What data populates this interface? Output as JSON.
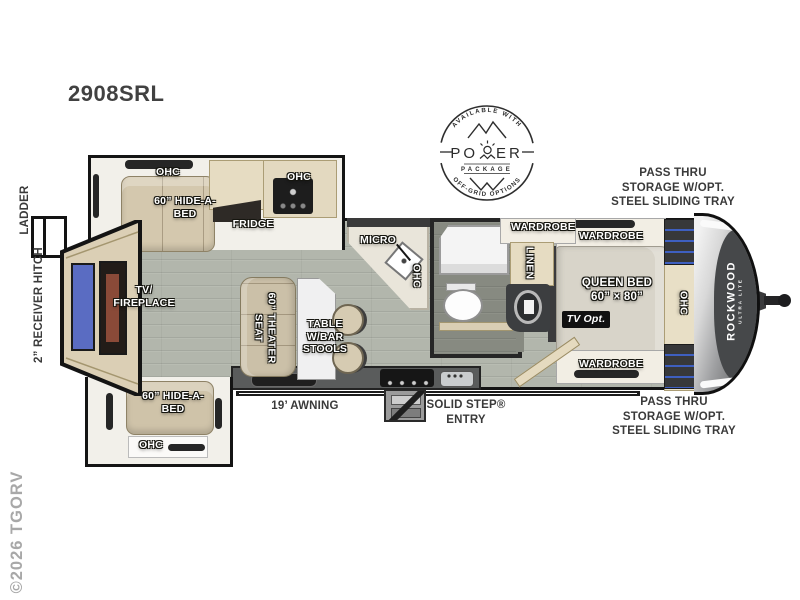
{
  "title": "2908SRL",
  "watermark": "©2026 TGORV",
  "badge": {
    "arc_top": "AVAILABLE WITH",
    "po": "PO",
    "er": "ER",
    "package": "PACKAGE",
    "arc_bottom": "OFF-GRID OPTIONS"
  },
  "branding": {
    "name": "ROCKWOOD",
    "sub": "ULTRA LITE"
  },
  "exterior": {
    "ladder": "LADDER",
    "receiver_hitch": "2” RECEIVER HITCH",
    "pass_thru_top": "PASS THRU\nSTORAGE W/OPT.\nSTEEL SLIDING TRAY",
    "pass_thru_bottom": "PASS THRU\nSTORAGE W/OPT.\nSTEEL SLIDING TRAY",
    "awning": "19’ AWNING",
    "entry": "SOLID STEP®\nENTRY"
  },
  "interior": {
    "ohc_top_slide": "OHC",
    "hide_a_bed_top": "60” HIDE-A-\nBED",
    "fridge": "FRIDGE",
    "ohc_range": "OHC",
    "micro": "MICRO",
    "ohc_kitchen": "OHC",
    "tv_fireplace": "TV/\nFIREPLACE",
    "theater_seat": "60” THEATER\nSEAT",
    "table": "TABLE\nW/BAR\nSTOOLS",
    "wardrobe_bath": "WARDROBE",
    "linen": "LINEN",
    "wardrobe_top": "WARDROBE",
    "queen_bed": "QUEEN BED\n60” × 80”",
    "tv_opt": "TV Opt.",
    "ohc_bedroom": "OHC",
    "wardrobe_bottom": "WARDROBE",
    "hide_a_bed_bottom": "60” HIDE-A-\nBED",
    "ohc_bottom_slide": "OHC"
  },
  "colors": {
    "floor": "#b2b6ac",
    "furniture_tan": "#d4c8ae",
    "cabinet_wood": "#e6dcc2",
    "wall_dark": "#141414",
    "tv_screen_blue": "#5a6cc2",
    "accent_blue": "#3e5fc0",
    "label_white": "#ffffff",
    "label_dark": "#3a3a3a",
    "watermark_gray": "#a8a8a8"
  }
}
